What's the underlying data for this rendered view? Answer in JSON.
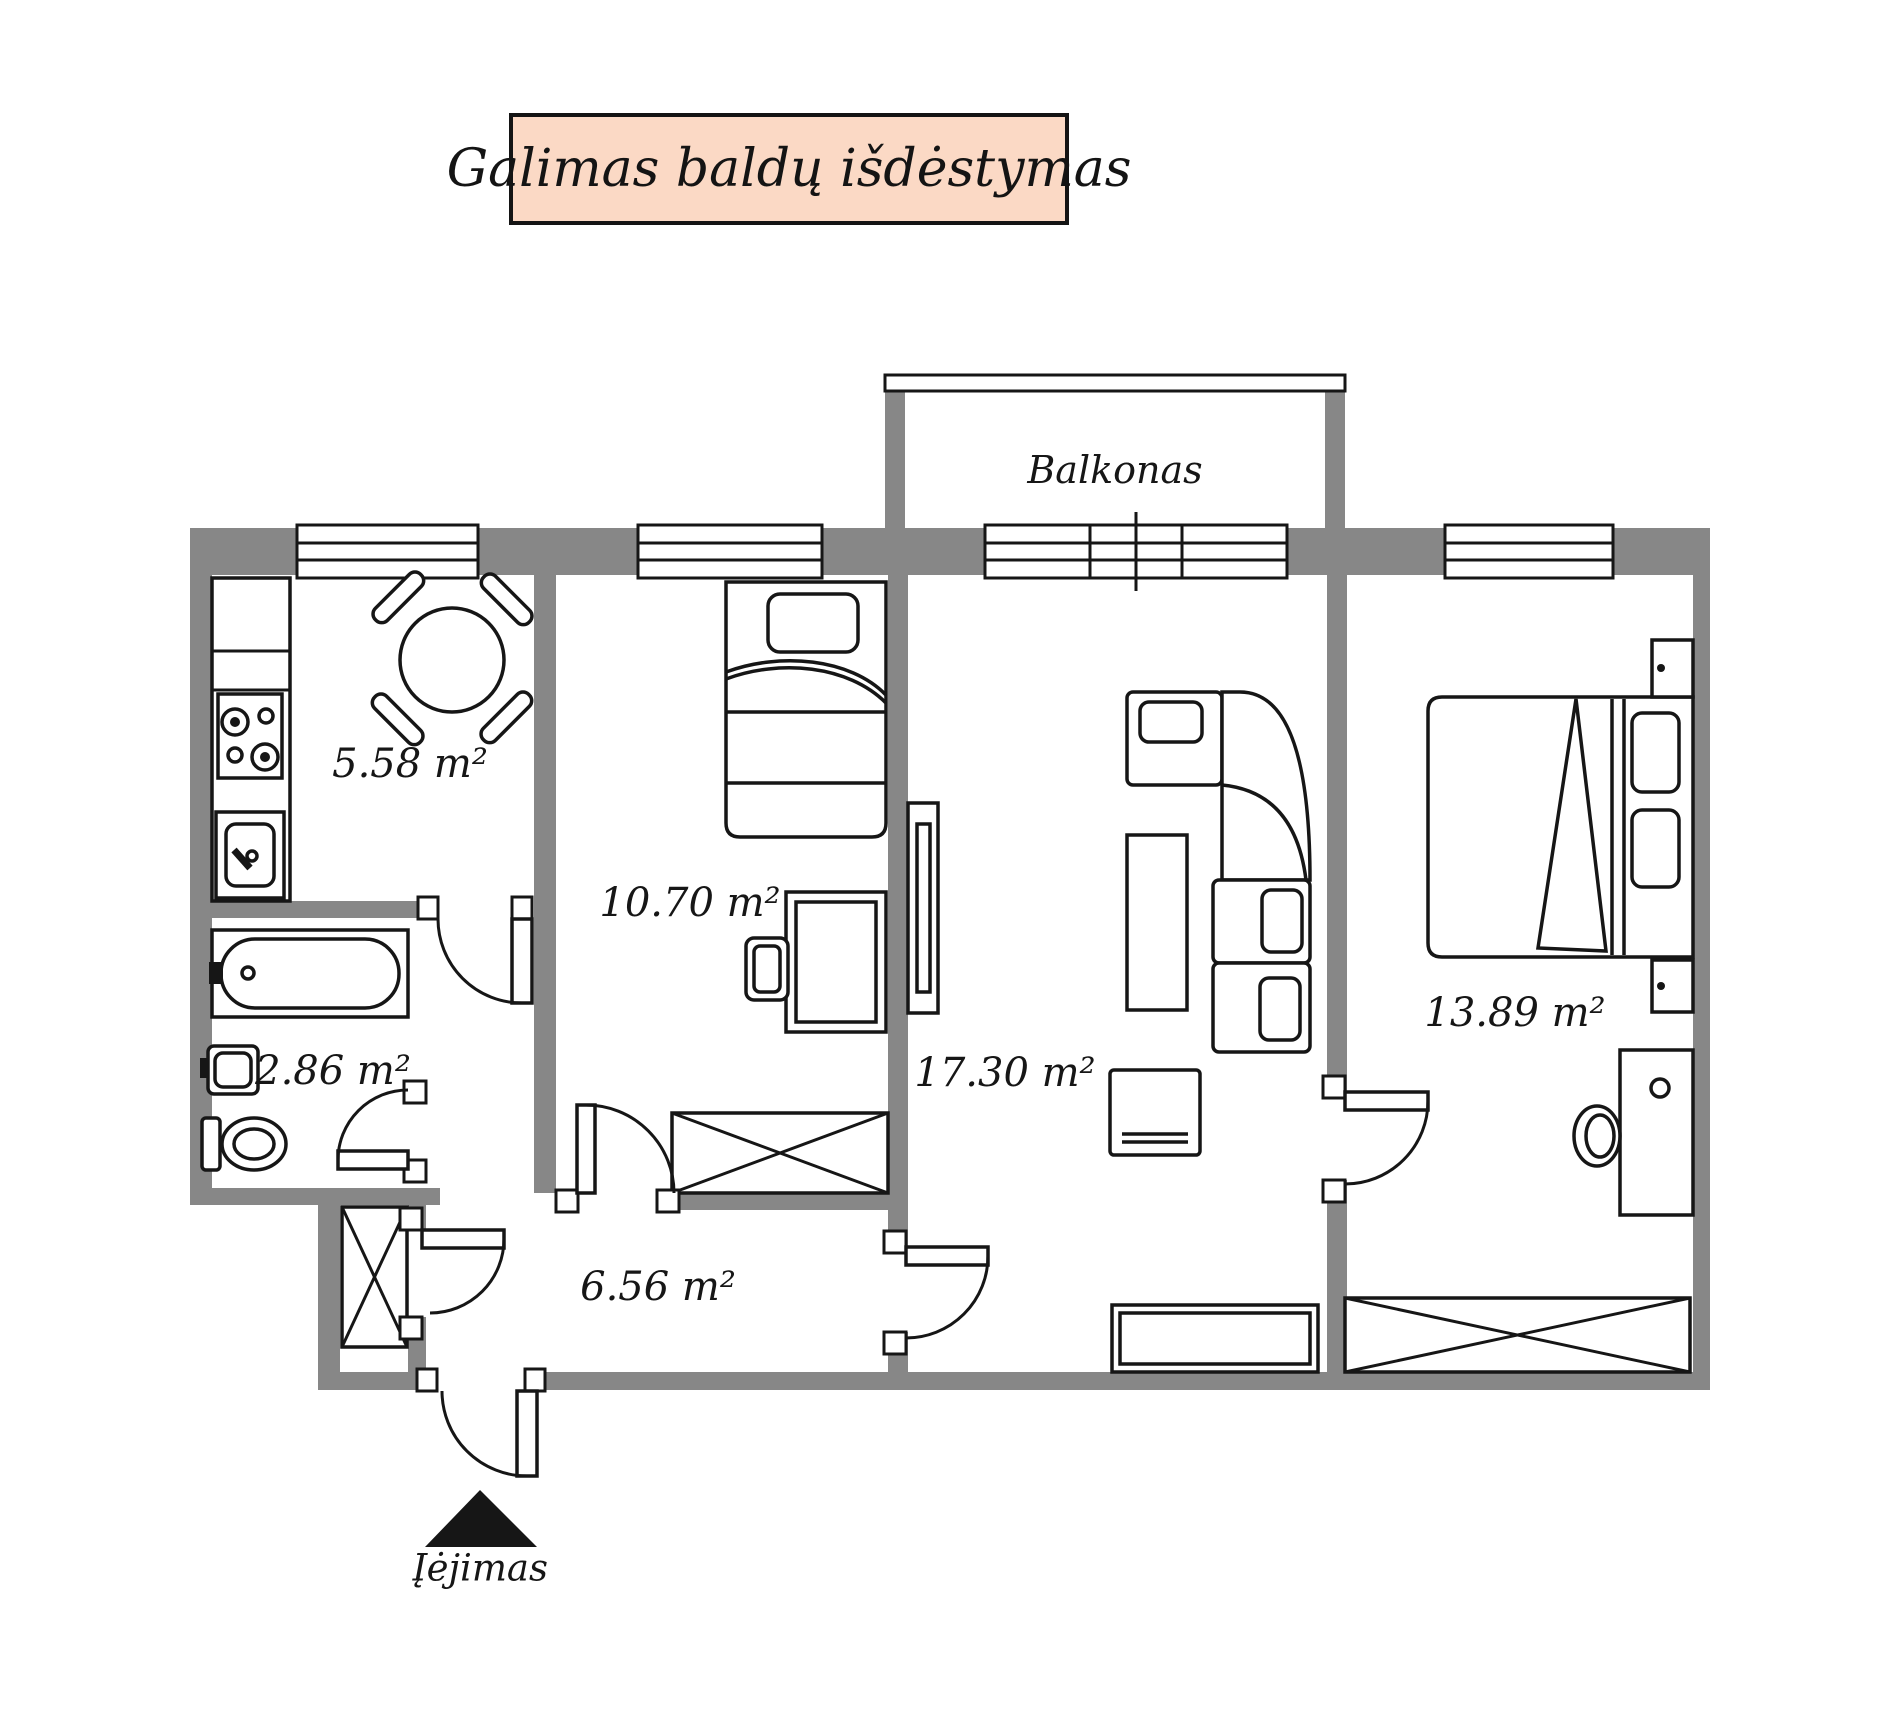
{
  "colors": {
    "wall": "#878787",
    "line": "#161616",
    "title_bg": "#fbd9c5"
  },
  "title": "Galimas baldų išdėstymas",
  "labels": {
    "balcony": "Balkonas",
    "entrance": "Įėjimas"
  },
  "areas": {
    "kitchen": "5.58 m²",
    "bathroom": "2.86 m²",
    "bedroom_small": "10.70 m²",
    "living": "17.30 m²",
    "bedroom_large": "13.89 m²",
    "hallway": "6.56 m²"
  }
}
